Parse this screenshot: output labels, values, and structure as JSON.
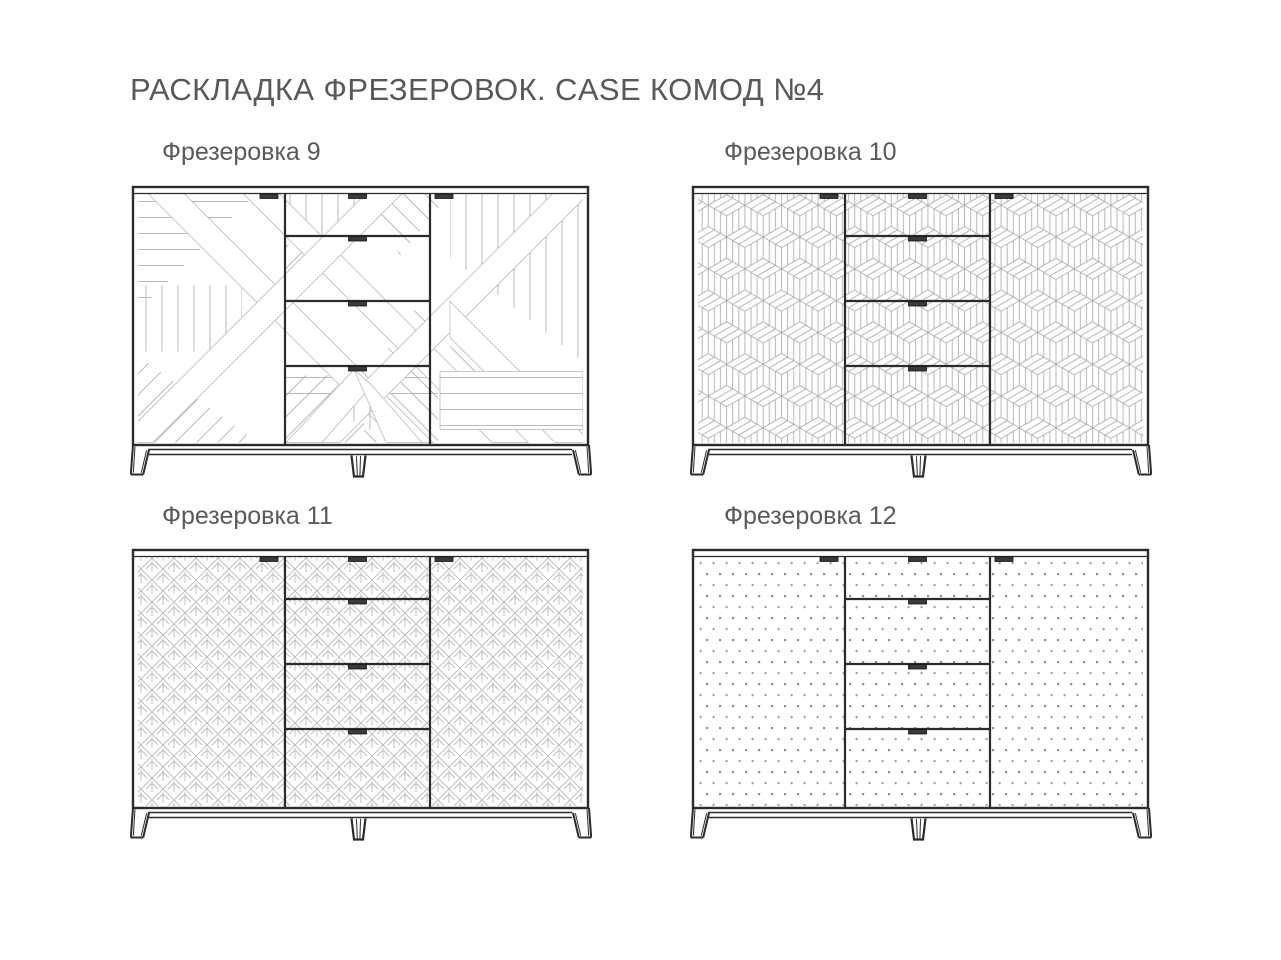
{
  "page": {
    "title": "РАСКЛАДКА ФРЕЗЕРОВОК. CASE КОМОД №4",
    "background": "#ffffff"
  },
  "colors": {
    "text": "#58595b",
    "outline": "#2b2b2b",
    "hatch": "#bababa",
    "band_edge": "#c8c8c8",
    "cube_line": "#b0b0b0",
    "leaf_line": "#bcbcbc",
    "dot_dark": "#8f8f8f",
    "dot_light": "#a6a6a6",
    "handle_fill": "#3a3a3a"
  },
  "variants": [
    {
      "id": "9",
      "label": "Фрезеровка 9",
      "pattern": "diagonal-patchwork"
    },
    {
      "id": "10",
      "label": "Фрезеровка 10",
      "pattern": "isometric-cubes"
    },
    {
      "id": "11",
      "label": "Фрезеровка 11",
      "pattern": "diamond-leaf"
    },
    {
      "id": "12",
      "label": "Фрезеровка 12",
      "pattern": "dot-grid"
    }
  ]
}
